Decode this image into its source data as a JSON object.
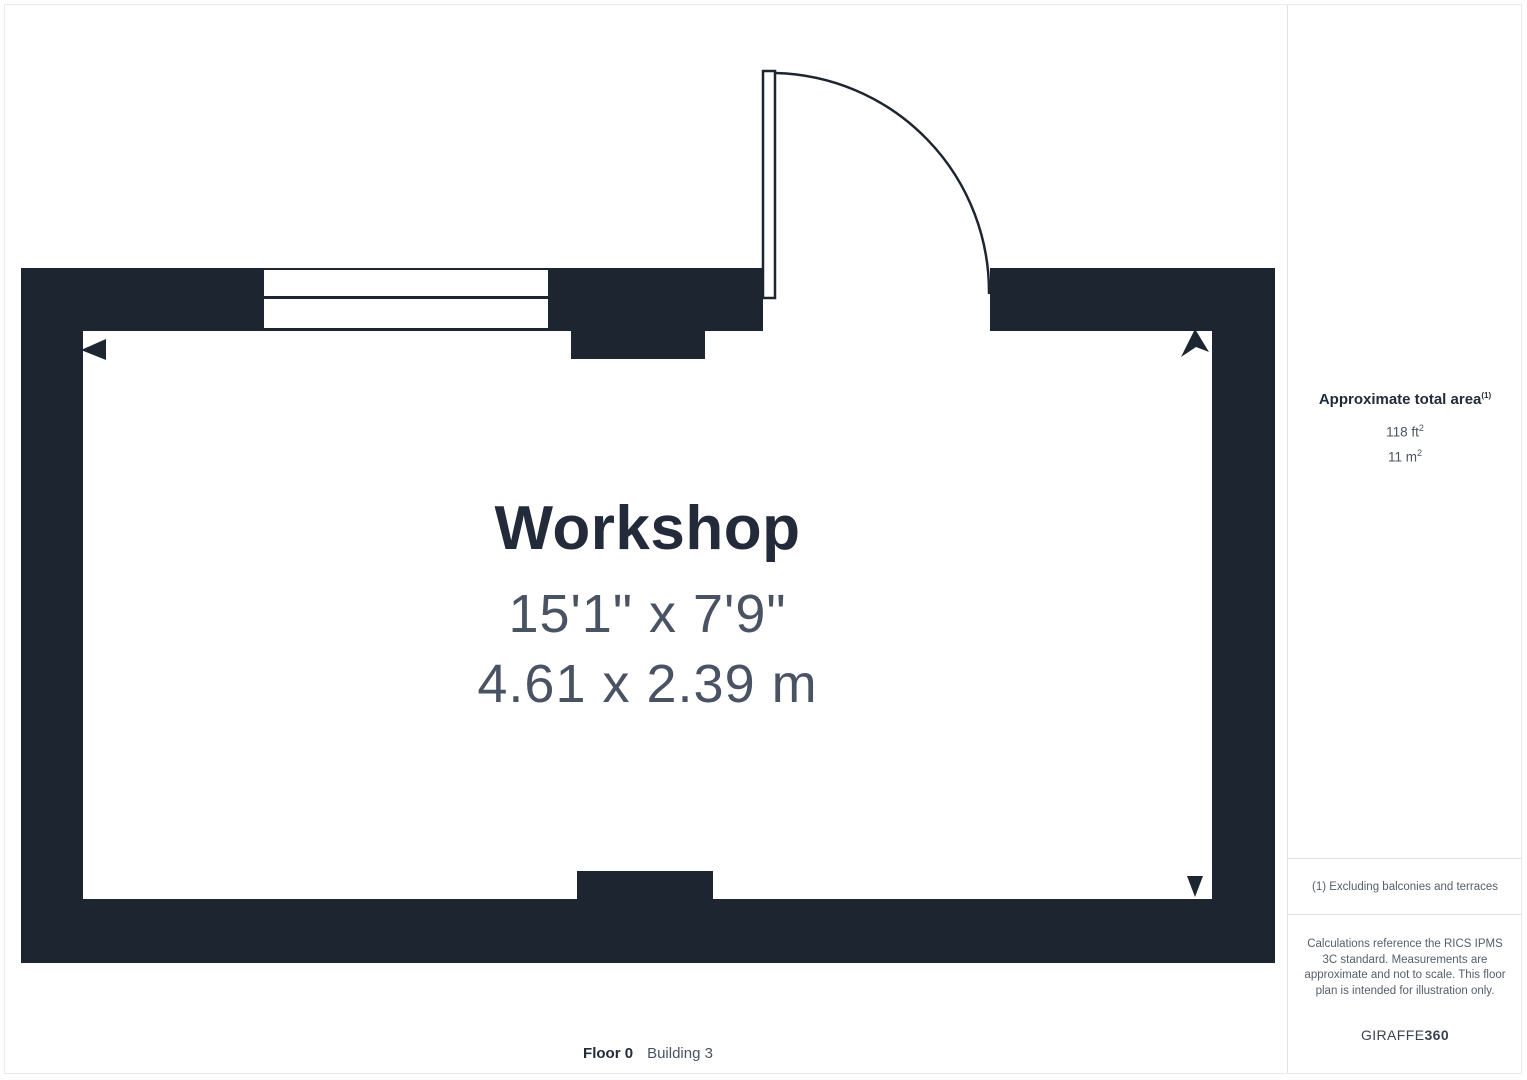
{
  "room": {
    "name": "Workshop",
    "dimensions_imperial": "15'1\" x 7'9\"",
    "dimensions_metric": "4.61 x 2.39 m"
  },
  "sidebar": {
    "area_title": "Approximate total area",
    "area_title_sup": "(1)",
    "area_imperial_value": "118 ft",
    "area_imperial_sup": "2",
    "area_metric_value": "11 m",
    "area_metric_sup": "2",
    "footnote": "(1) Excluding balconies and terraces",
    "disclaimer": "Calculations reference the RICS IPMS 3C standard. Measurements are approximate and not to scale. This floor plan is intended for illustration only.",
    "brand_regular": "GIRAFFE",
    "brand_bold": "360"
  },
  "footer": {
    "floor_label": "Floor 0",
    "building_label": "Building 3"
  },
  "colors": {
    "wall": "#1d2531",
    "title_text": "#232b3a",
    "dimension_text": "#4a5363",
    "muted_text": "#545e6b",
    "divider": "#dfe1e4"
  }
}
